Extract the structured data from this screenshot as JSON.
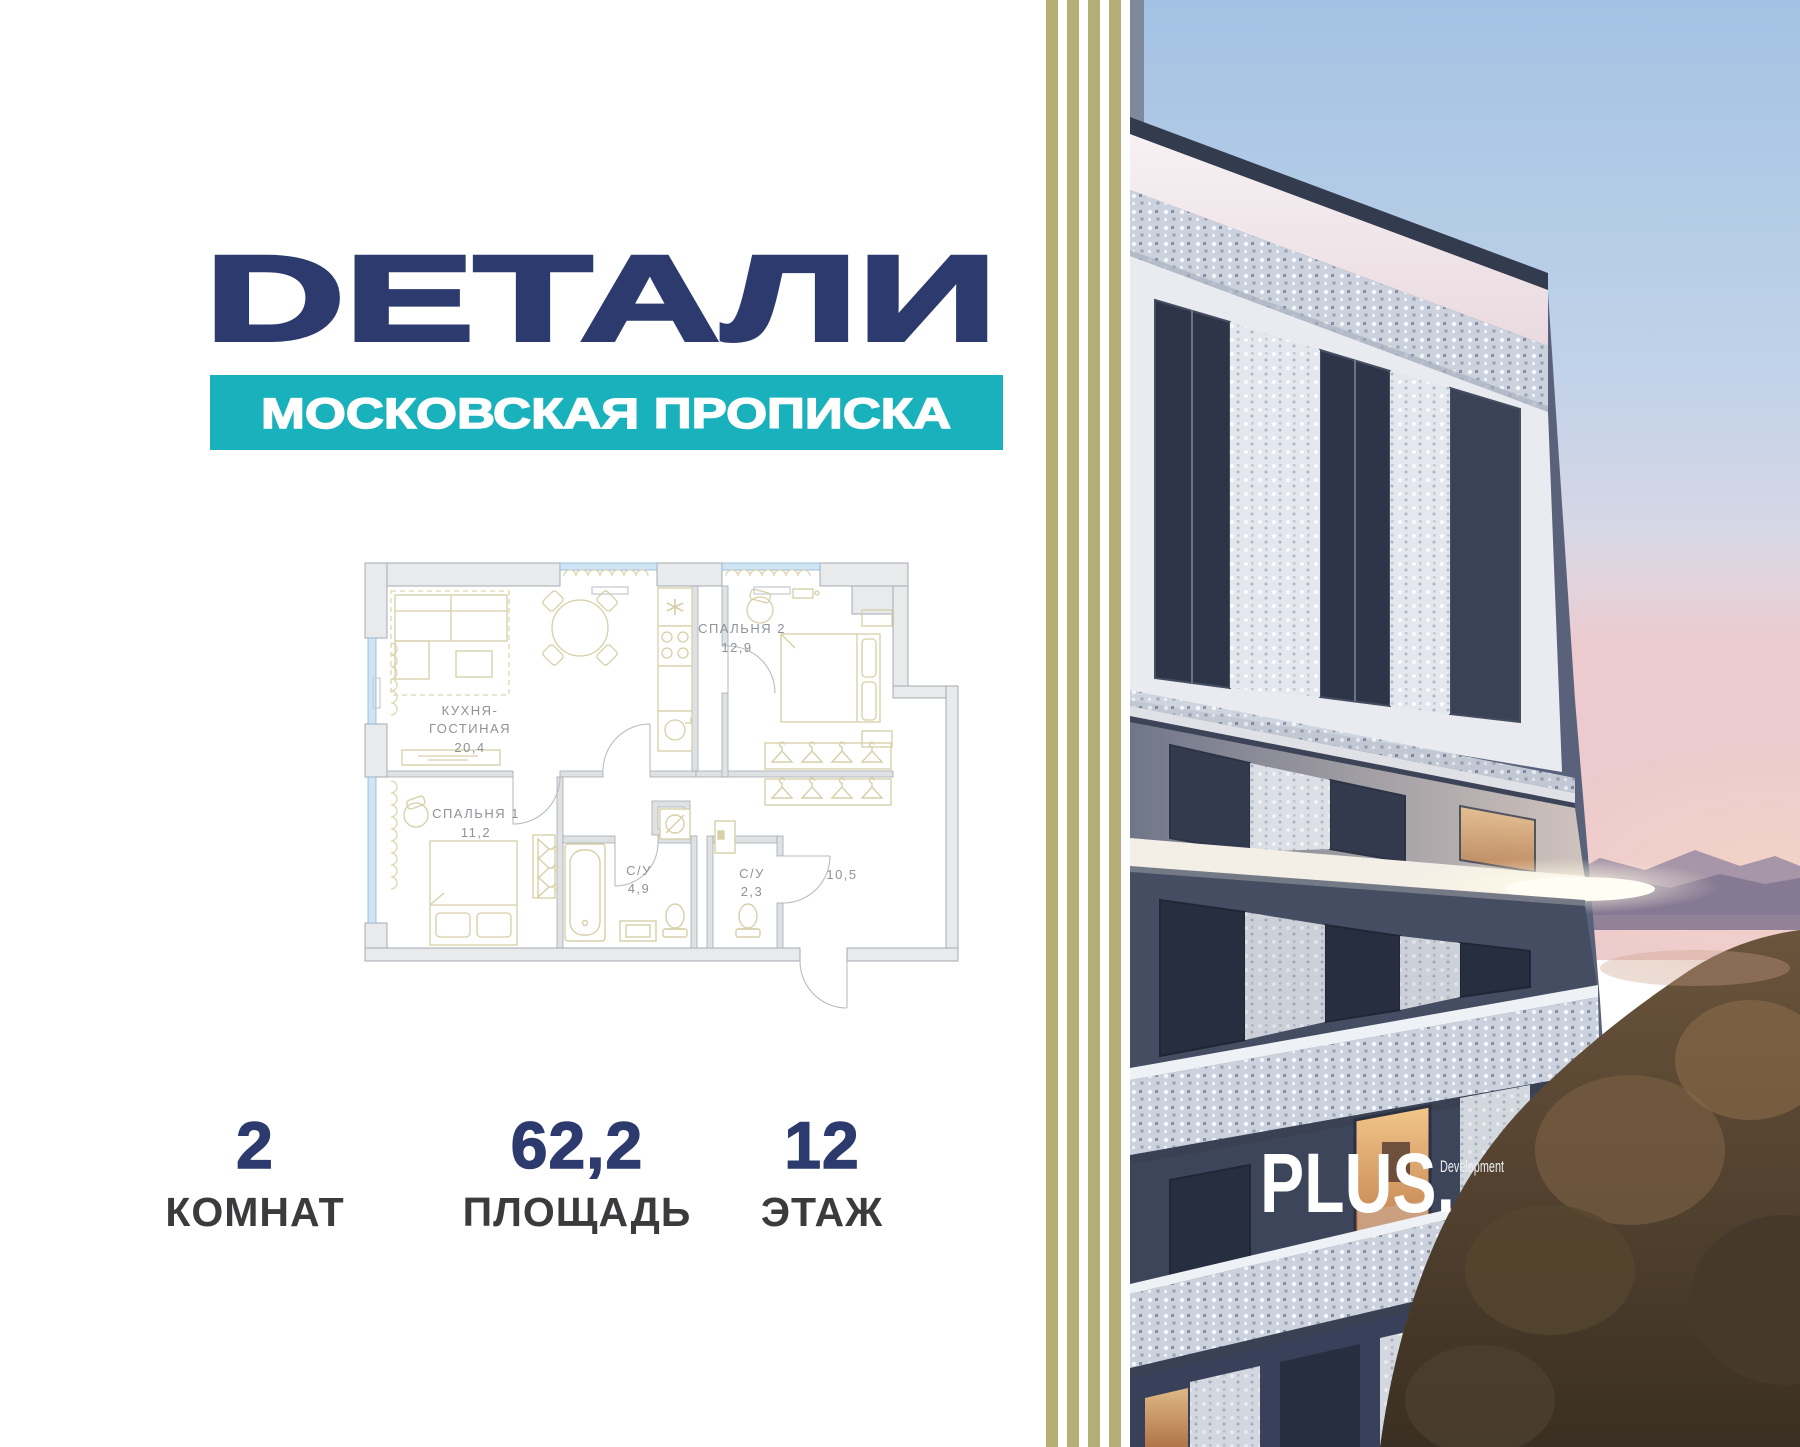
{
  "brand": {
    "logo": "DЕТАЛИ",
    "tagline": "МОСКОВСКАЯ ПРОПИСКА"
  },
  "floor_plan": {
    "kitchen_living": {
      "label_line1": "КУХНЯ-",
      "label_line2": "ГОСТИНАЯ",
      "area": "20,4"
    },
    "bedroom2": {
      "label": "СПАЛЬНЯ 2",
      "area": "12,9"
    },
    "bedroom1": {
      "label": "СПАЛЬНЯ 1",
      "area": "11,2"
    },
    "bathroom1": {
      "label": "С/У",
      "area": "4,9"
    },
    "bathroom2": {
      "label": "С/У",
      "area": "2,3"
    },
    "hallway": {
      "area": "10,5"
    }
  },
  "stats": {
    "rooms": {
      "value": "2",
      "label": "КОМНАТ"
    },
    "area": {
      "value": "62,2",
      "label": "ПЛОЩАДЬ"
    },
    "floor": {
      "value": "12",
      "label": "ЭТАЖ"
    }
  },
  "developer": {
    "name": "PLUS.",
    "suffix": "Development"
  },
  "colors": {
    "navy": "#2d3a6e",
    "teal": "#18b1bc",
    "stripe_olive": "#b4b075",
    "stat_label_grey": "#3b3b3d",
    "plan_label_grey": "#8d9399",
    "plan_wall_fill": "#e8eaec",
    "plan_wall_line": "#a5abb0",
    "furniture_beige": "#d6cfa8",
    "window_blue": "#cfe4f5"
  }
}
